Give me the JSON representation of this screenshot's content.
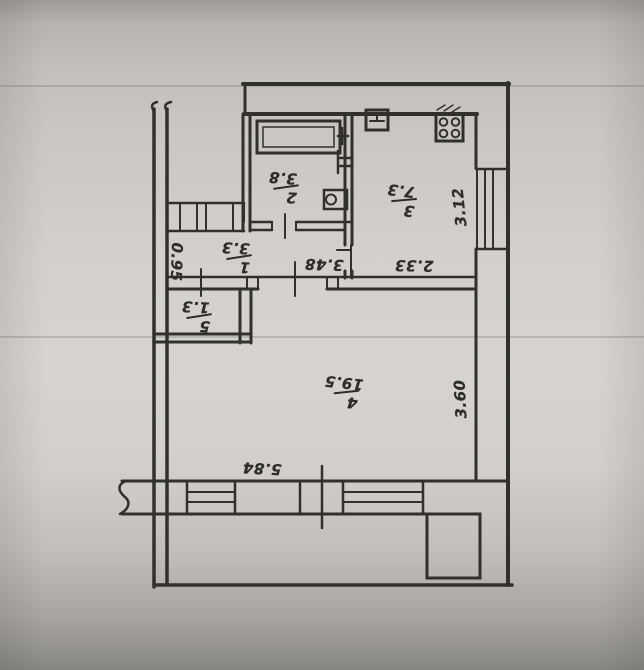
{
  "drawing": {
    "title": "apartment-floor-plan",
    "ink_color": "#32302c",
    "paper_color": "#d3d0cc",
    "rooms": [
      {
        "number": "1",
        "area": "3.3",
        "name": "hallway"
      },
      {
        "number": "2",
        "area": "3.8",
        "name": "bathroom"
      },
      {
        "number": "3",
        "area": "7.3",
        "name": "kitchen"
      },
      {
        "number": "4",
        "area": "19.5",
        "name": "living-room"
      },
      {
        "number": "5",
        "area": "1.3",
        "name": "closet"
      }
    ],
    "dimensions": {
      "hall_width": "0.95",
      "hall_length": "3.48",
      "kitchen_width": "2.33",
      "kitchen_depth": "3.12",
      "room4_depth": "3.60",
      "room4_width": "5.84"
    },
    "fixtures": [
      "bathtub",
      "toilet",
      "wash-basin",
      "kitchen-sink",
      "stove"
    ]
  }
}
